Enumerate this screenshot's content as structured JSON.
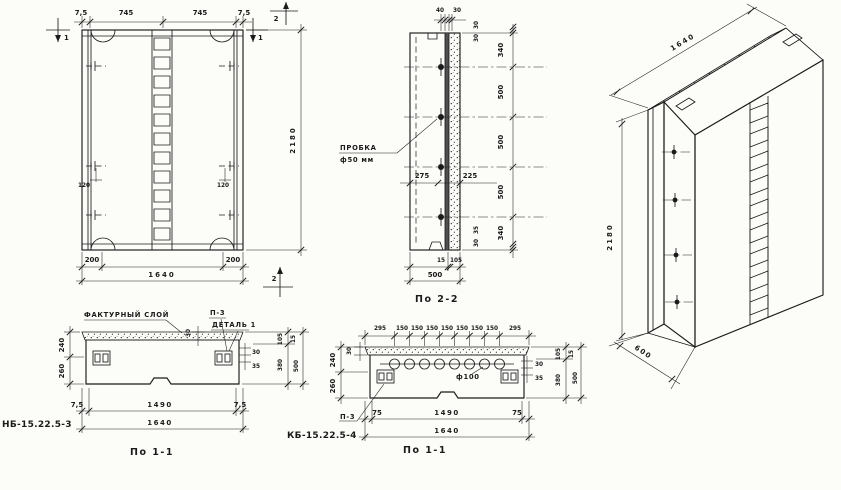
{
  "drawing": {
    "front": {
      "top_dims": [
        "7,5",
        "745",
        "745",
        "7,5"
      ],
      "mark_left": "1",
      "mark_right": "1",
      "mark_top": "2",
      "mark_bottom": "2",
      "dim_120_left": "120",
      "dim_120_right": "120",
      "dim_200_left": "200",
      "dim_200_right": "200",
      "dim_width": "1640",
      "dim_height": "2180"
    },
    "section22": {
      "title": "По 2-2",
      "dim_top_40": "40",
      "dim_top_30": "30",
      "chain_top": [
        "30",
        "30"
      ],
      "chain": [
        "340",
        "500",
        "500",
        "500",
        "340"
      ],
      "chain_bottom": [
        "35",
        "30"
      ],
      "dim_275": "275",
      "dim_225": "225",
      "callout_line1": "ПРОБКА",
      "callout_line2": "ф50 мм",
      "dim_15": "15",
      "dim_105": "105",
      "dim_500": "500"
    },
    "iso": {
      "dim_width": "1640",
      "dim_height": "2180",
      "dim_depth": "600"
    },
    "sectionA": {
      "mark": "НБ-15.22.5-3",
      "title": "По 1-1",
      "callout_facing": "ФАКТУРНЫЙ СЛОЙ",
      "callout_p3": "П-3",
      "callout_detail": "ДЕТАЛЬ 1",
      "dim_30_top": "30",
      "left_chain": [
        "240",
        "260"
      ],
      "right_dims": [
        "30",
        "35"
      ],
      "right_chain": [
        "105",
        "15",
        "380",
        "500"
      ],
      "bottom_dims": [
        "7,5",
        "1490",
        "7,5"
      ],
      "dim_width": "1640"
    },
    "sectionB": {
      "mark": "КБ-15.22.5-4",
      "title": "По 1-1",
      "callout_p3": "П-3",
      "dim_hole": "ф100",
      "dim_30_left": "30",
      "top_dims": [
        "295",
        "150",
        "150",
        "150",
        "150",
        "150",
        "150",
        "150",
        "295"
      ],
      "left_chain": [
        "240",
        "260"
      ],
      "right_dims": [
        "30",
        "35"
      ],
      "right_chain": [
        "105",
        "15",
        "380",
        "500"
      ],
      "bottom_dims": [
        "75",
        "1490",
        "75"
      ],
      "dim_width": "1640"
    }
  }
}
